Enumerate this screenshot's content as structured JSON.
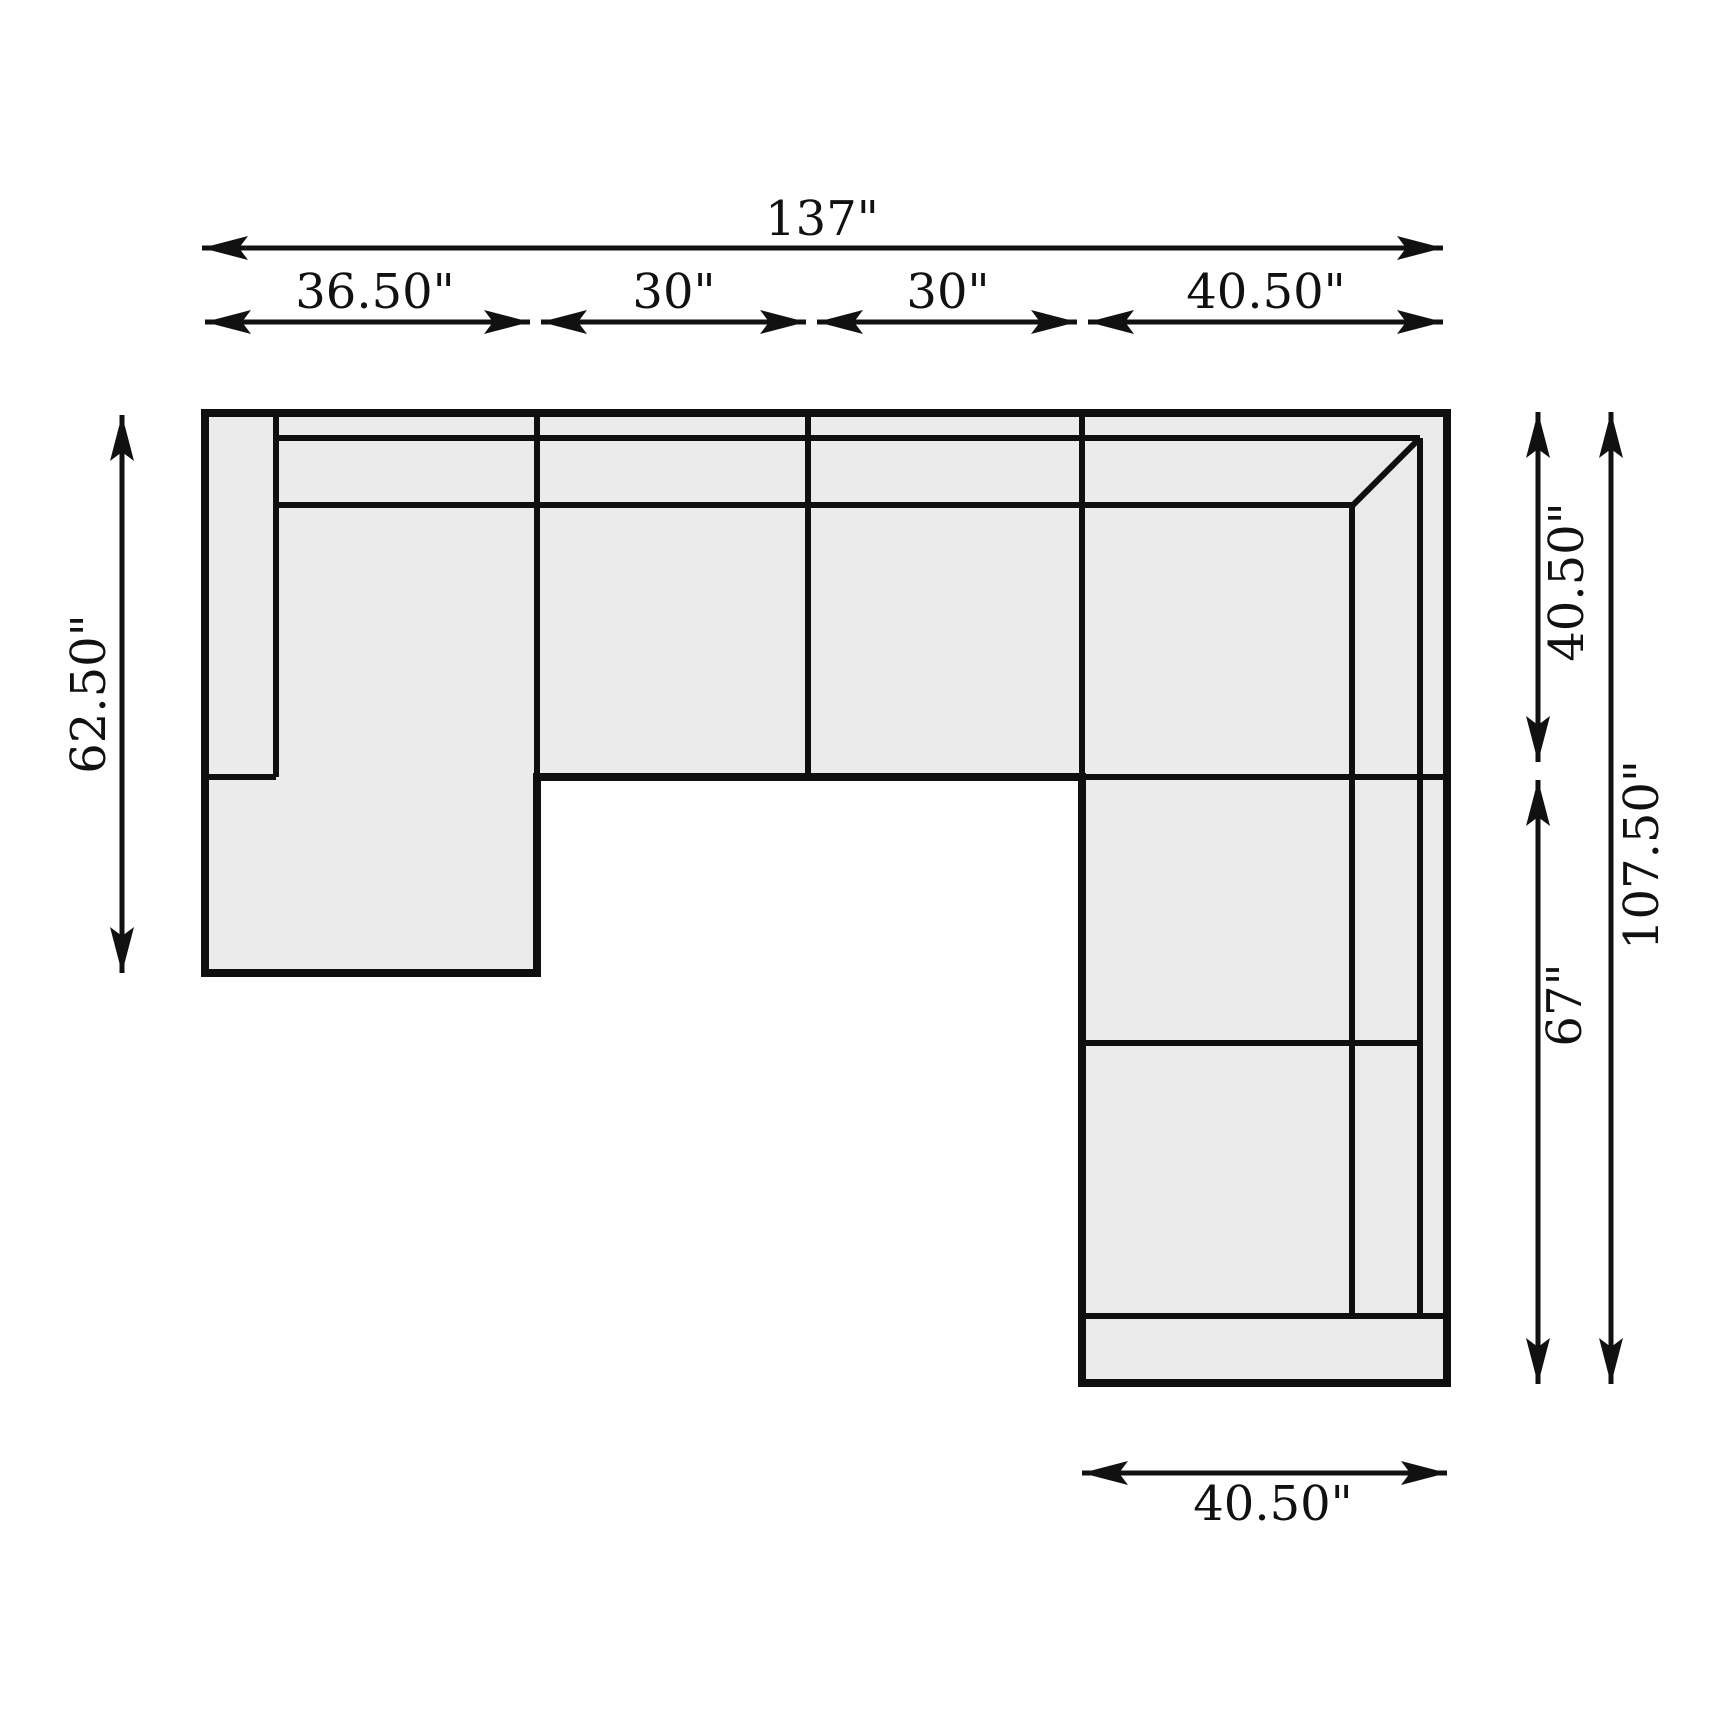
{
  "diagram": {
    "title": "sectional-sofa-dimension-diagram",
    "units": "inches",
    "colors": {
      "background": "#ffffff",
      "sofa_fill": "#ebebeb",
      "line": "#0f0f0f",
      "dimension_line": "#111111"
    },
    "dimensions": {
      "overall_width": {
        "label": "137\""
      },
      "top_segments": [
        {
          "label": "36.50\""
        },
        {
          "label": "30\""
        },
        {
          "label": "30\""
        },
        {
          "label": "40.50\""
        }
      ],
      "left_depth": {
        "label": "62.50\""
      },
      "right_upper_depth": {
        "label": "40.50\""
      },
      "right_lower_depth": {
        "label": "67\""
      },
      "right_total_depth": {
        "label": "107.50\""
      },
      "bottom_width": {
        "label": "40.50\""
      }
    }
  }
}
